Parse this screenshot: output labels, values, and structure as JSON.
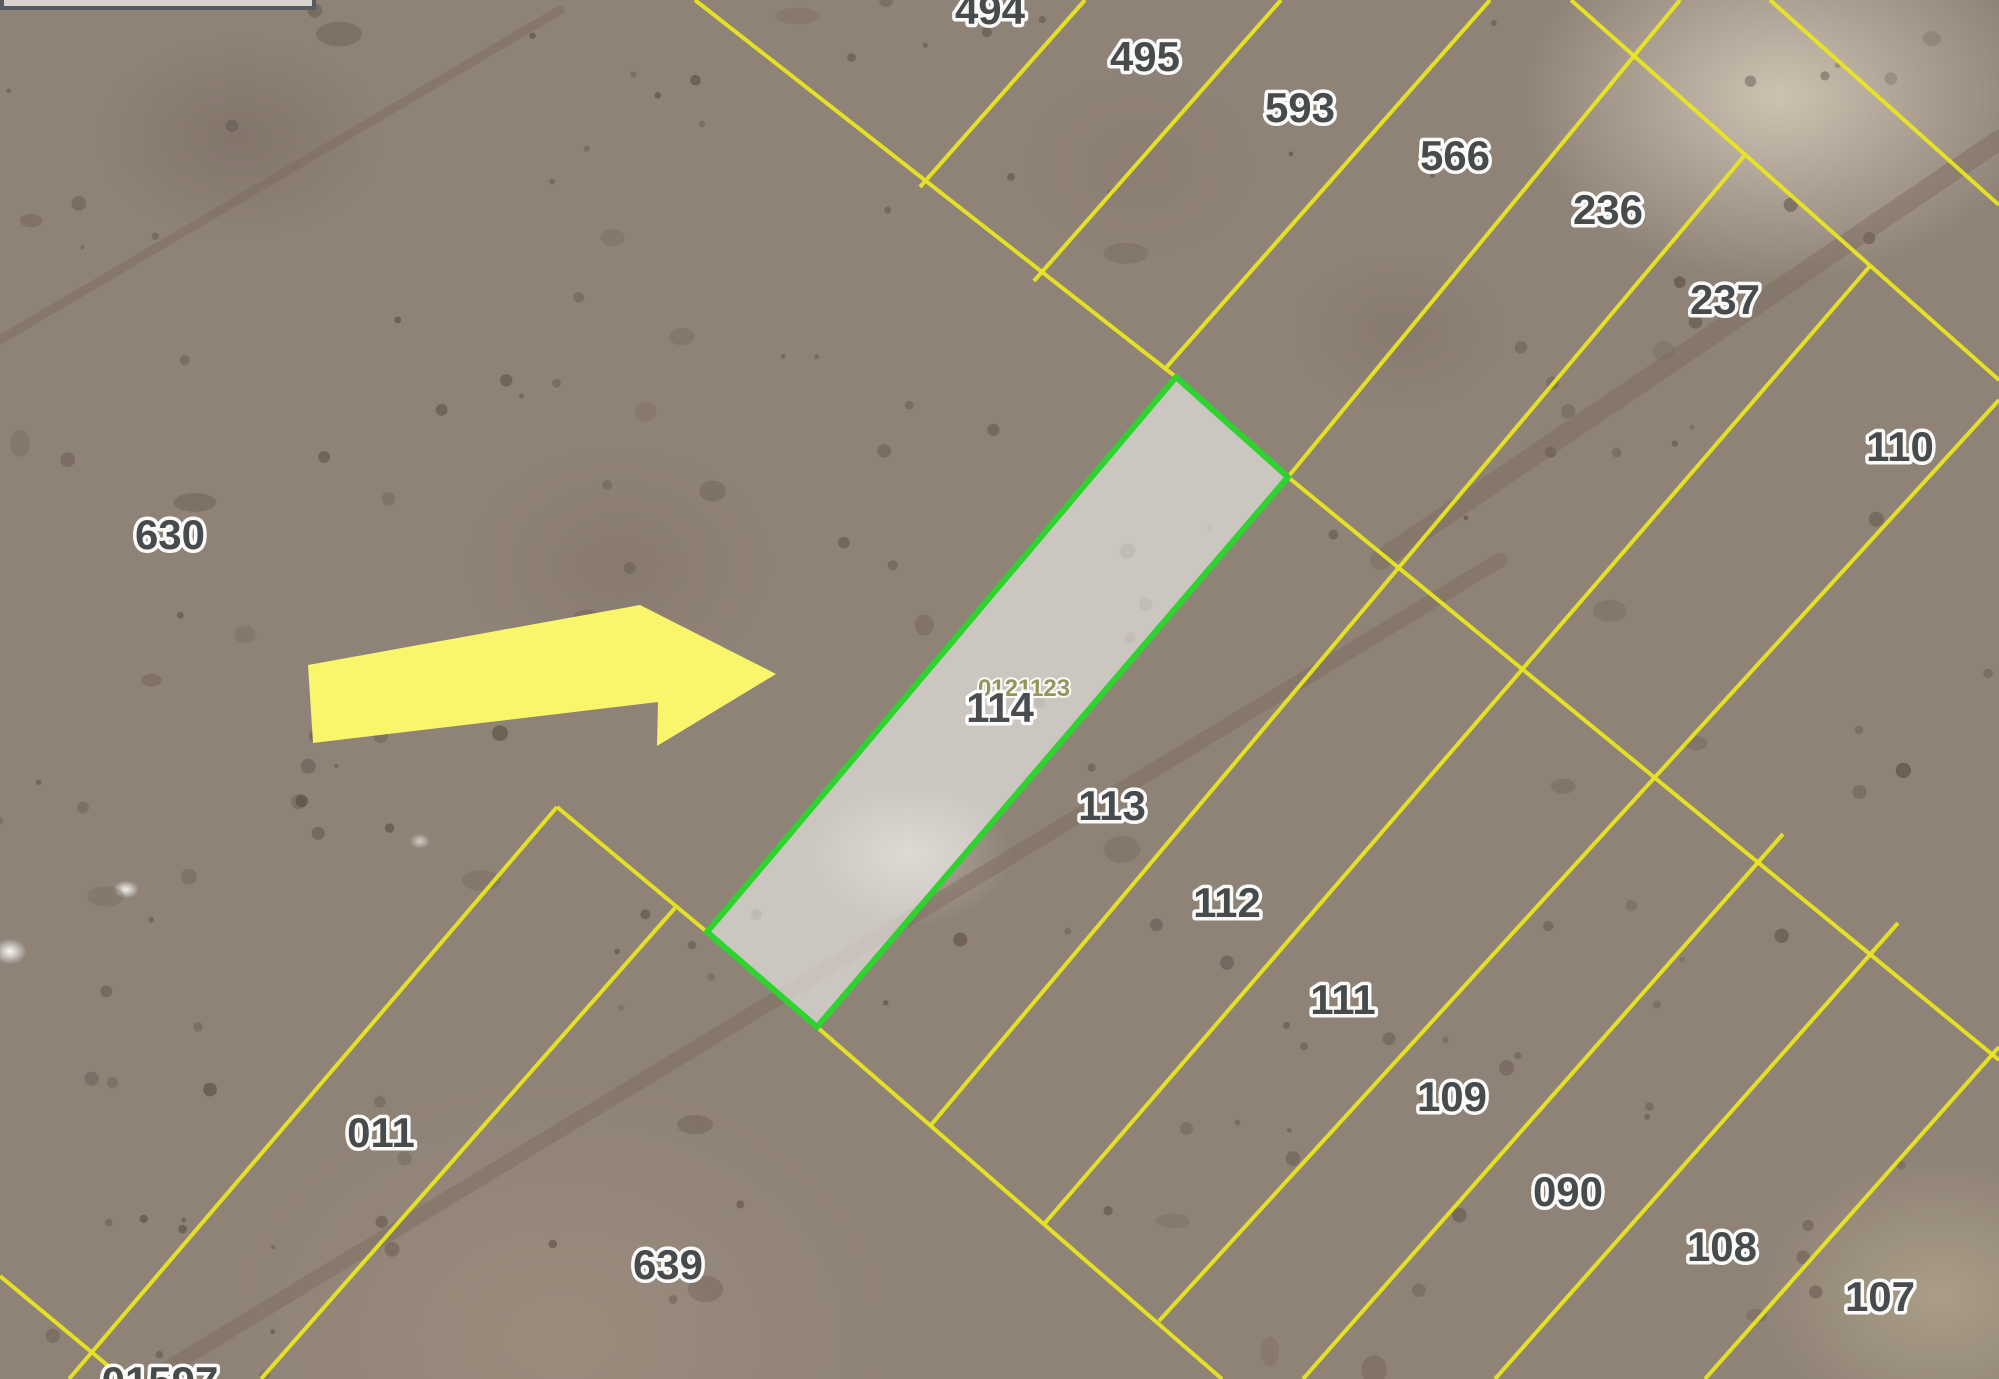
{
  "map_view": {
    "background_color": "#8f8277",
    "boundary_lines": {
      "color": "#e9e622",
      "width": 4,
      "segments": [
        [
          695,
          0,
          1176,
          377
        ],
        [
          1288,
          477,
          1999,
          1060
        ],
        [
          1571,
          0,
          1999,
          380
        ],
        [
          1770,
          0,
          1999,
          205
        ],
        [
          557,
          807,
          707,
          932
        ],
        [
          817,
          1027,
          1222,
          1379
        ],
        [
          1085,
          0,
          920,
          187
        ],
        [
          1281,
          0,
          1034,
          281
        ],
        [
          1490,
          0,
          1164,
          370
        ],
        [
          1680,
          0,
          1288,
          477
        ],
        [
          1745,
          155,
          931,
          1125
        ],
        [
          1870,
          266,
          1045,
          1223
        ],
        [
          1999,
          400,
          1159,
          1321
        ],
        [
          1783,
          834,
          1303,
          1379
        ],
        [
          1898,
          923,
          1495,
          1379
        ],
        [
          1999,
          1047,
          1705,
          1379
        ],
        [
          557,
          807,
          69,
          1379
        ],
        [
          675,
          908,
          261,
          1379
        ],
        [
          0,
          1276,
          124,
          1379
        ]
      ]
    },
    "dirt_tracks": {
      "color": "rgba(122,106,90,0.45)",
      "segments": [
        {
          "pts": [
            150,
            1379,
            1500,
            560
          ],
          "w": 15
        },
        {
          "pts": [
            1999,
            140,
            1380,
            560
          ],
          "w": 20
        },
        {
          "pts": [
            0,
            340,
            560,
            10
          ],
          "w": 9
        }
      ]
    },
    "selected_parcel": {
      "number": "114",
      "code": "0121123",
      "outline_color": "#2fd330",
      "fill_color": "rgba(255,255,255,0.55)",
      "polygon": [
        [
          1176,
          377
        ],
        [
          1288,
          477
        ],
        [
          817,
          1027
        ],
        [
          707,
          932
        ]
      ],
      "label_pos": [
        1000,
        722
      ],
      "code_pos": [
        1024,
        696
      ]
    },
    "pointer_arrow": {
      "color": "#f9f66b",
      "polygon": [
        [
          308,
          665
        ],
        [
          640,
          605
        ],
        [
          776,
          674
        ],
        [
          657,
          746
        ],
        [
          658,
          702
        ],
        [
          313,
          743
        ]
      ]
    },
    "parcel_labels": [
      {
        "text": "494",
        "x": 990,
        "y": 24
      },
      {
        "text": "495",
        "x": 1145,
        "y": 71
      },
      {
        "text": "593",
        "x": 1300,
        "y": 122
      },
      {
        "text": "566",
        "x": 1455,
        "y": 170
      },
      {
        "text": "236",
        "x": 1608,
        "y": 224
      },
      {
        "text": "237",
        "x": 1725,
        "y": 314
      },
      {
        "text": "110",
        "x": 1900,
        "y": 461
      },
      {
        "text": "630",
        "x": 170,
        "y": 549
      },
      {
        "text": "113",
        "x": 1112,
        "y": 820
      },
      {
        "text": "112",
        "x": 1227,
        "y": 917
      },
      {
        "text": "111",
        "x": 1343,
        "y": 1014
      },
      {
        "text": "109",
        "x": 1452,
        "y": 1111
      },
      {
        "text": "090",
        "x": 1568,
        "y": 1206
      },
      {
        "text": "108",
        "x": 1722,
        "y": 1261
      },
      {
        "text": "107",
        "x": 1880,
        "y": 1311
      },
      {
        "text": "011",
        "x": 381,
        "y": 1147
      },
      {
        "text": "639",
        "x": 668,
        "y": 1279
      },
      {
        "text": "01597",
        "x": 160,
        "y": 1396
      }
    ],
    "cropped_panel": {
      "visible": true
    }
  }
}
